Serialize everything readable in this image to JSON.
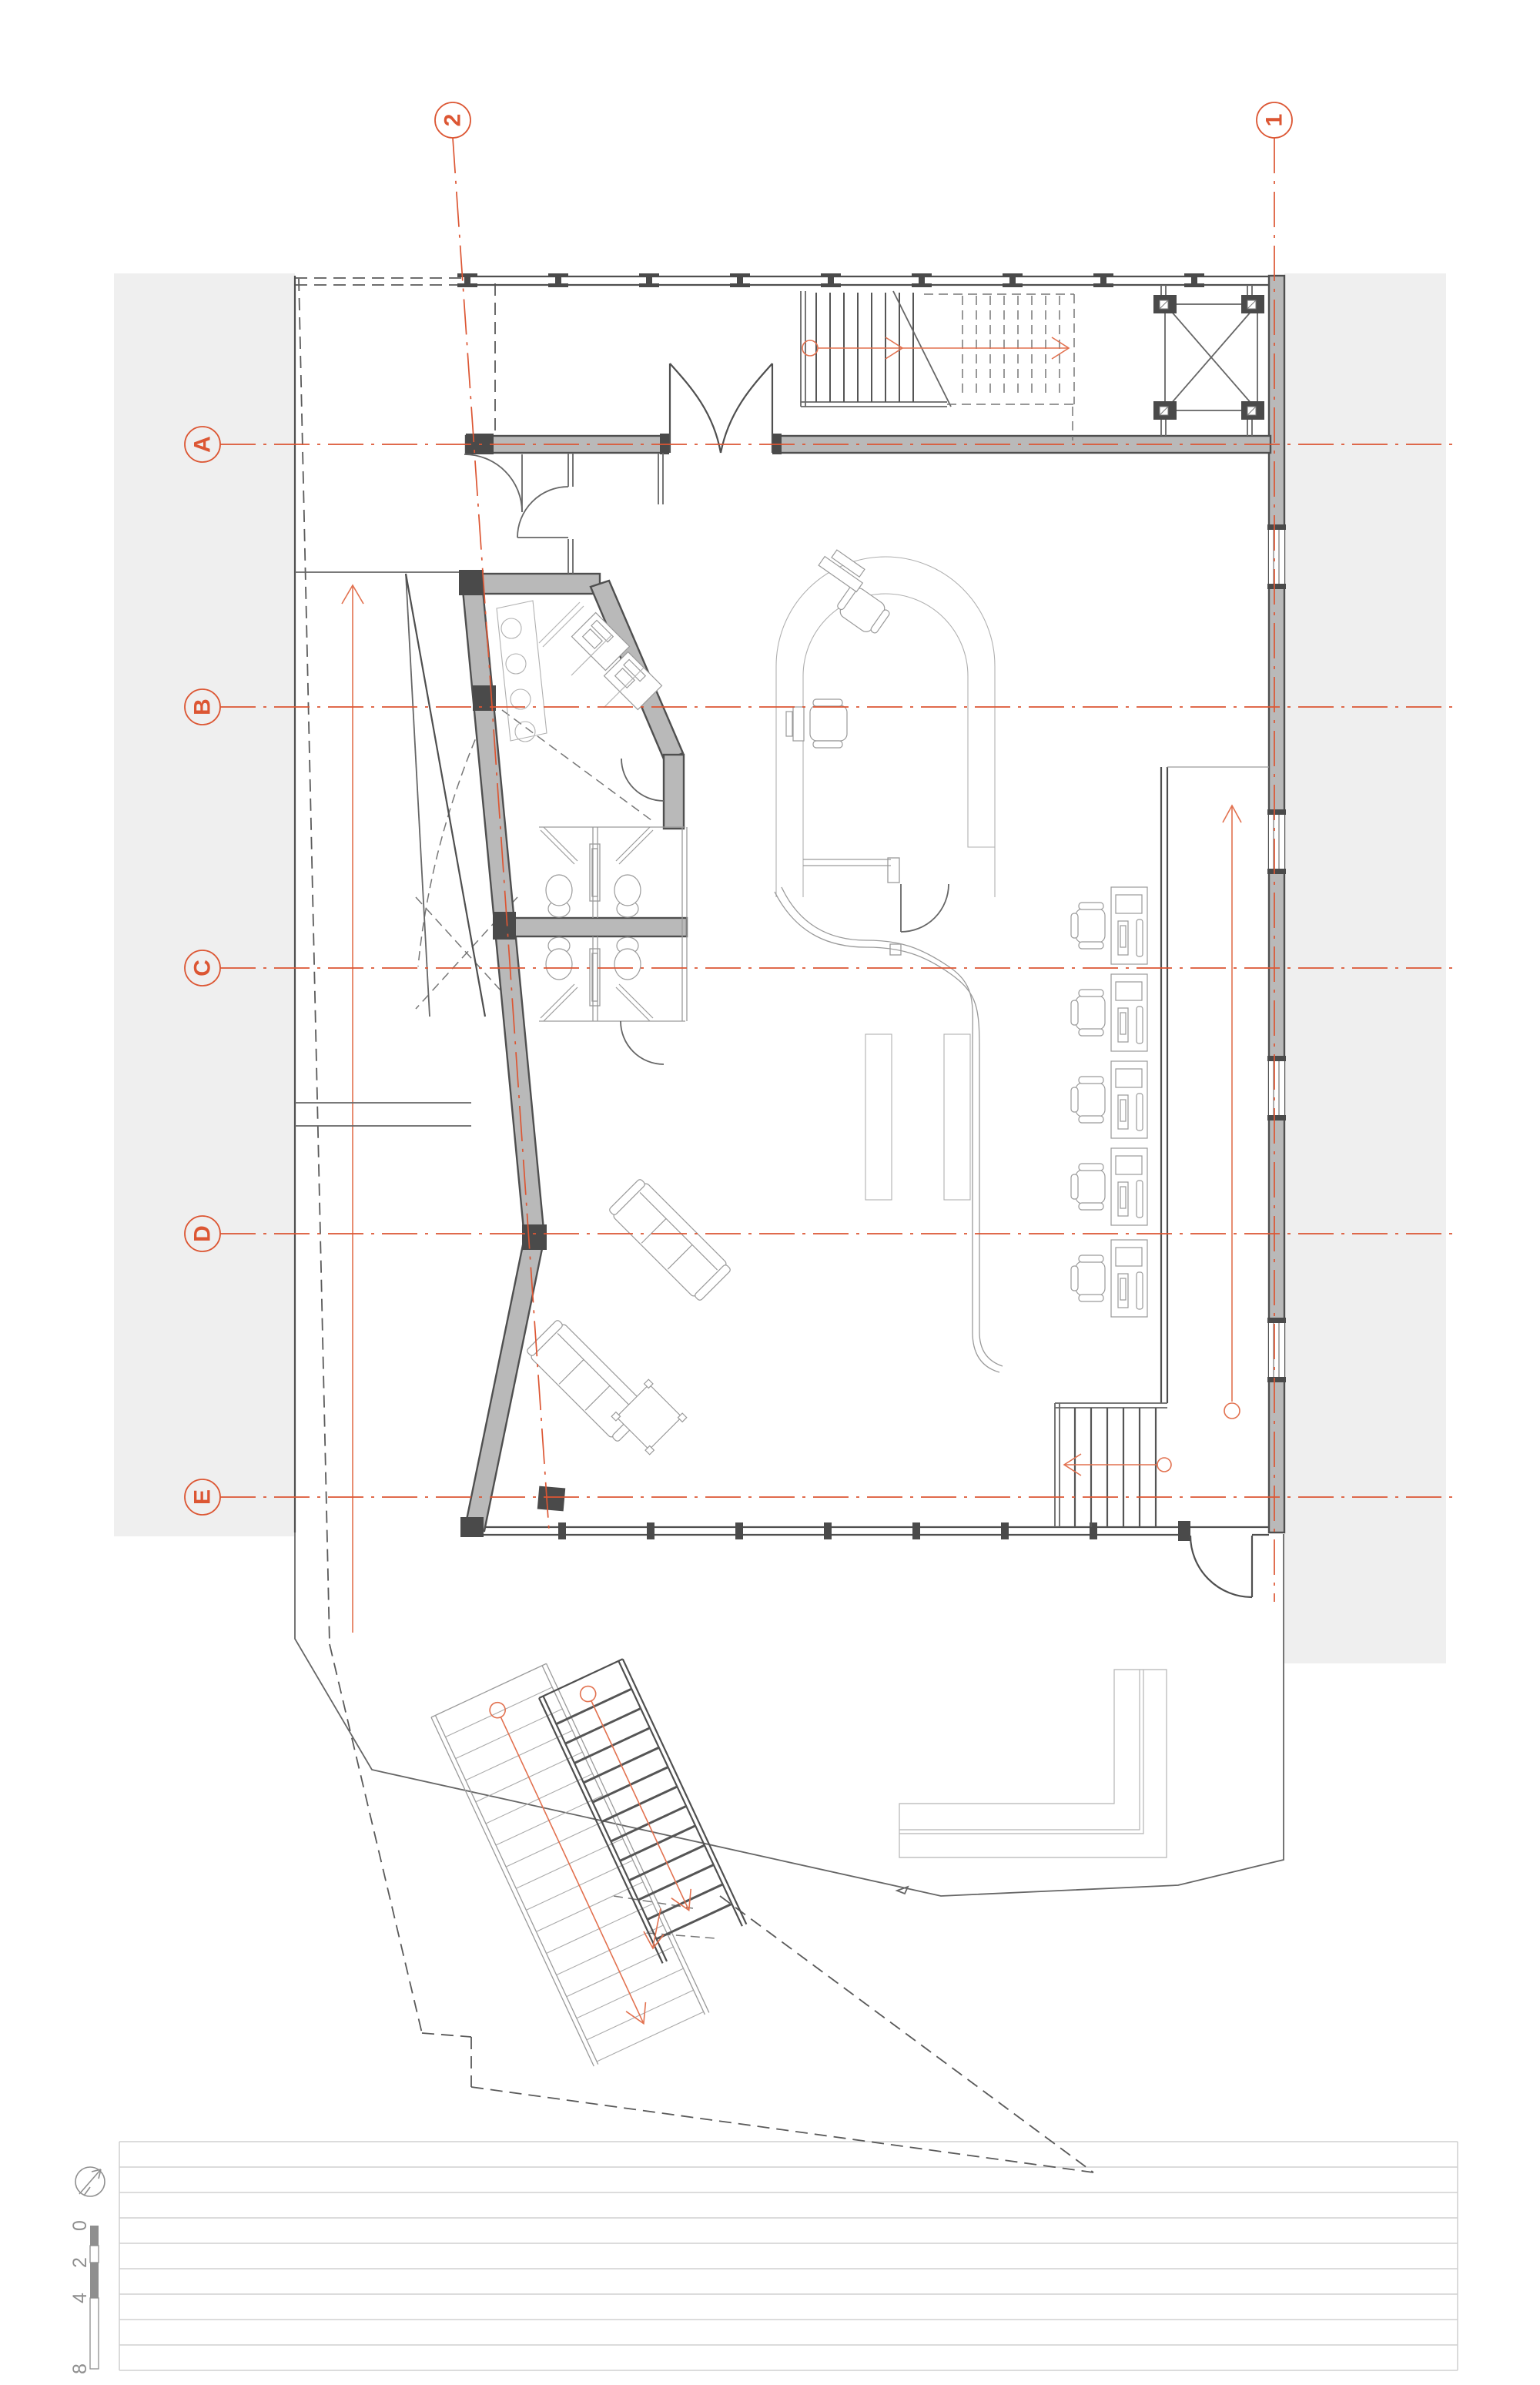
{
  "grid_bubbles": {
    "vertical": [
      {
        "label": "2"
      },
      {
        "label": "1"
      }
    ],
    "horizontal": [
      {
        "label": "A"
      },
      {
        "label": "B"
      },
      {
        "label": "C"
      },
      {
        "label": "D"
      },
      {
        "label": "E"
      }
    ]
  },
  "scale_bar": {
    "marks": [
      "0",
      "2",
      "4",
      "8"
    ]
  },
  "icons": {
    "north": "north-arrow-icon"
  },
  "colors": {
    "accent": "#DC5633",
    "wall_fill": "#b9b9b9",
    "wall_edge": "#4f4f4f",
    "dark_block": "#4a4a4a",
    "background_band": "#efefef",
    "thin_line": "#9a9a9a",
    "ruled_line": "#dcdcdc",
    "scale_gray": "#8f8f8f"
  }
}
